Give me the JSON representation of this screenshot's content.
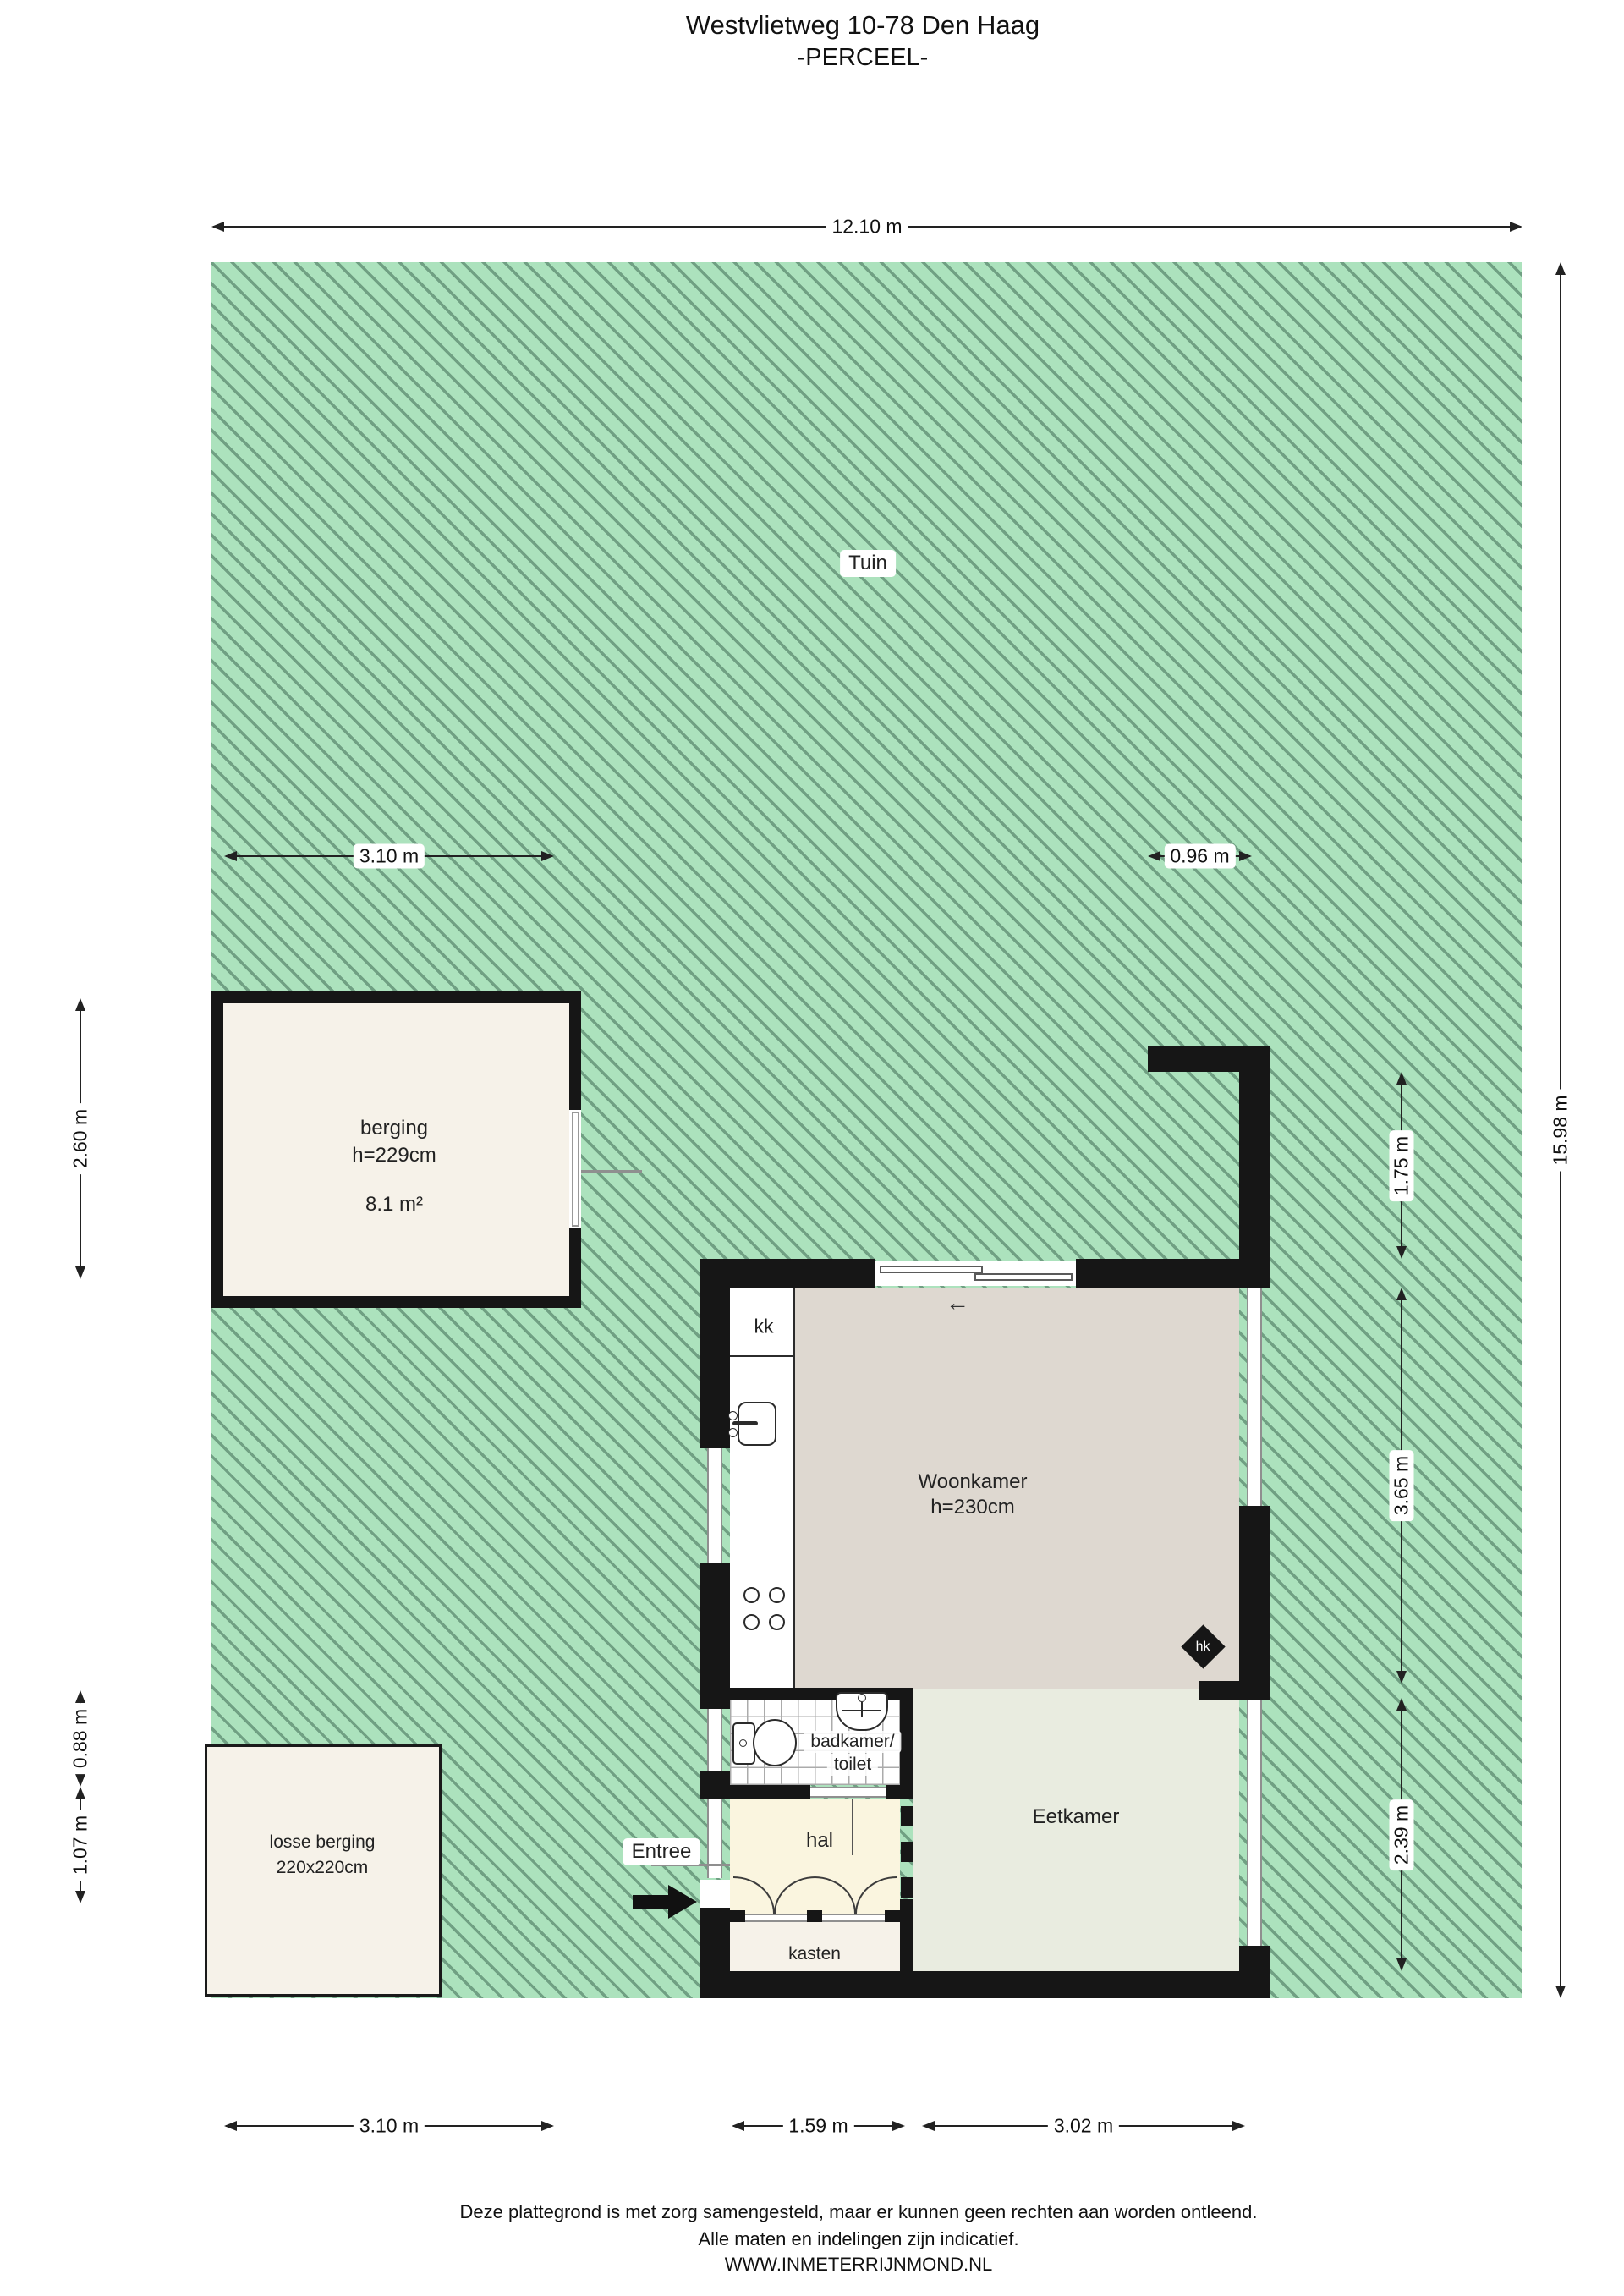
{
  "title": {
    "line1": "Westvlietweg 10-78 Den Haag",
    "line2": "-PERCEEL-"
  },
  "garden": {
    "label": "Tuin"
  },
  "rooms": {
    "berging": {
      "name": "berging",
      "ceiling": "h=229cm",
      "area": "8.1 m²"
    },
    "losse_berging": {
      "name": "losse berging",
      "size": "220x220cm"
    },
    "woonkamer": {
      "name": "Woonkamer",
      "ceiling": "h=230cm"
    },
    "eetkamer": {
      "name": "Eetkamer"
    },
    "hal": {
      "name": "hal"
    },
    "badkamer": {
      "line1": "badkamer/",
      "line2": "toilet"
    },
    "kasten": {
      "name": "kasten"
    },
    "kitchen": {
      "name": "kk"
    },
    "hk": {
      "name": "hk"
    }
  },
  "entree": {
    "label": "Entree"
  },
  "dimensions": {
    "plot_width": "12.10 m",
    "plot_height": "15.98 m",
    "berging_width": "3.10 m",
    "right_gap": "0.96 m",
    "berging_height": "2.60 m",
    "wall_segment": "1.75 m",
    "woonkamer_side": "3.65 m",
    "eetkamer_side": "2.39 m",
    "left_upper": "0.88 m",
    "left_lower": "1.07 m",
    "bottom_left": "3.10 m",
    "bottom_hal": "1.59 m",
    "bottom_eetkamer": "3.02 m"
  },
  "footer": {
    "line1": "Deze plattegrond is met zorg samengesteld, maar er kunnen geen rechten aan worden ontleend.",
    "line2": "Alle maten en indelingen zijn indicatief.",
    "line3": "WWW.INMETERRIJNMOND.NL"
  },
  "colors": {
    "garden_green": "#ace2bd",
    "hatch_line": "#70a083",
    "wall_black": "#161616",
    "floor_cream": "#f6f2e9",
    "floor_woonkamer": "#ded8d0",
    "floor_eetkamer": "#e9ece0",
    "floor_hal": "#faf5df"
  }
}
